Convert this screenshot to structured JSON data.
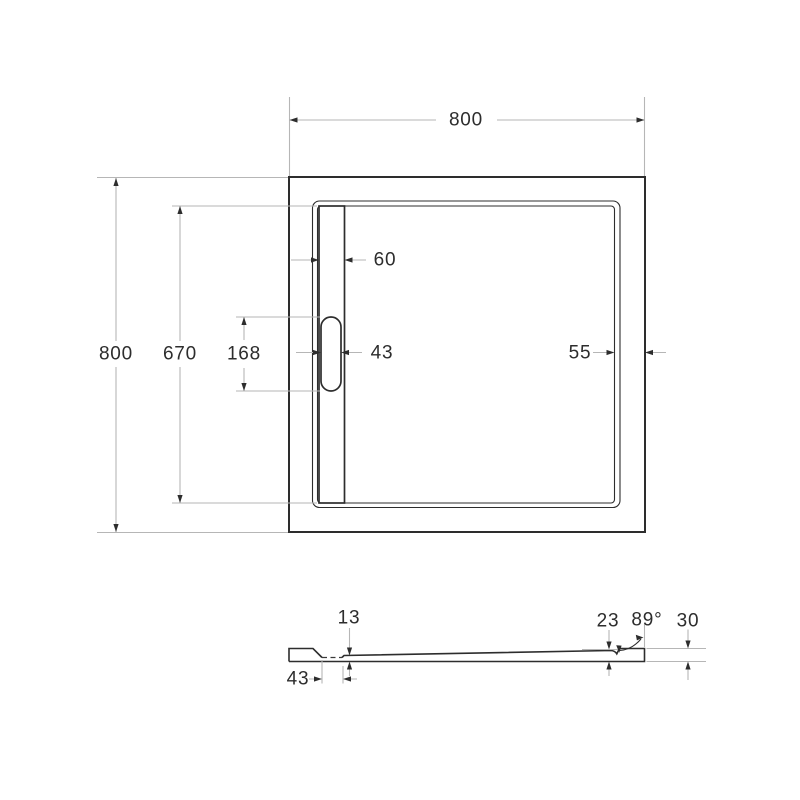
{
  "colors": {
    "background": "#ffffff",
    "outline": "#2d2d2d",
    "dimension_line": "#b6b6b6",
    "text": "#2d2d2d"
  },
  "top_view": {
    "dims": {
      "overall_width": "800",
      "overall_depth": "800",
      "channel_length": "670",
      "slot_length": "168",
      "channel_width": "60",
      "slot_width": "43",
      "rim_to_edge": "55"
    }
  },
  "section_view": {
    "dims": {
      "floor_thickness": "13",
      "recess_width": "43",
      "edge_thickness": "23",
      "wall_angle": "89°",
      "overall_height": "30"
    }
  }
}
